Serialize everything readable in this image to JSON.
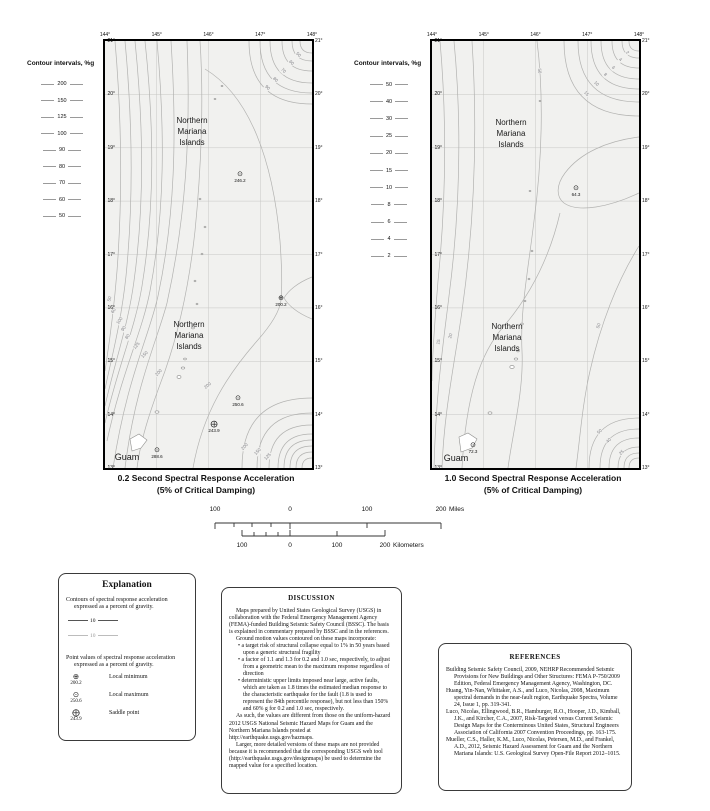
{
  "maps": [
    {
      "name": "0.2-second map",
      "legend_title": "Contour intervals, %g",
      "legend_values": [
        "200",
        "150",
        "125",
        "100",
        "90",
        "80",
        "70",
        "60",
        "50"
      ],
      "lon_labels": [
        "144°",
        "145°",
        "146°",
        "147°",
        "148°"
      ],
      "lat_labels": [
        "21°",
        "20°",
        "19°",
        "18°",
        "17°",
        "16°",
        "15°",
        "14°",
        "13°"
      ],
      "title_line1": "0.2 Second Spectral Response Acceleration",
      "title_line2": "(5% of Critical Damping)",
      "region_labels": [
        {
          "text": "Northern\nMariana\nIslands",
          "x": 87,
          "y": 91
        },
        {
          "text": "Northern\nMariana\nIslands",
          "x": 84,
          "y": 295
        },
        {
          "text": "Guam",
          "x": 22,
          "y": 416,
          "size": 9
        }
      ],
      "points": [
        {
          "value": "246.2",
          "type": "local-maximum",
          "symbol": "⊙",
          "x": 135,
          "y": 135
        },
        {
          "value": "200.2",
          "type": "local-minimum",
          "symbol": "⊕",
          "x": 176,
          "y": 259
        },
        {
          "value": "250.6",
          "type": "local-maximum",
          "symbol": "⊙",
          "x": 133,
          "y": 359
        },
        {
          "value": "243.9",
          "type": "saddle-point",
          "symbol": "⨁",
          "x": 109,
          "y": 385
        },
        {
          "value": "288.6",
          "type": "local-maximum",
          "symbol": "⊙",
          "x": 52,
          "y": 411
        }
      ],
      "contour_labels": [
        {
          "text": "50",
          "x": 5,
          "y": 258,
          "rot": -75
        },
        {
          "text": "60",
          "x": 9,
          "y": 270,
          "rot": -60
        },
        {
          "text": "100",
          "x": 15,
          "y": 280,
          "rot": -55
        },
        {
          "text": "90",
          "x": 19,
          "y": 288,
          "rot": -55
        },
        {
          "text": "80",
          "x": 23,
          "y": 296,
          "rot": -55
        },
        {
          "text": "125",
          "x": 32,
          "y": 305,
          "rot": -50
        },
        {
          "text": "150",
          "x": 40,
          "y": 314,
          "rot": -45
        },
        {
          "text": "200",
          "x": 54,
          "y": 332,
          "rot": -45
        },
        {
          "text": "200",
          "x": 103,
          "y": 345,
          "rot": -40
        },
        {
          "text": "200",
          "x": 140,
          "y": 406,
          "rot": -45
        },
        {
          "text": "150",
          "x": 153,
          "y": 411,
          "rot": -45
        },
        {
          "text": "125",
          "x": 163,
          "y": 416,
          "rot": -45
        },
        {
          "text": "90",
          "x": 162,
          "y": 47,
          "rot": 45
        },
        {
          "text": "80",
          "x": 170,
          "y": 39,
          "rot": 45
        },
        {
          "text": "70",
          "x": 178,
          "y": 30,
          "rot": 45
        },
        {
          "text": "60",
          "x": 186,
          "y": 22,
          "rot": 45
        },
        {
          "text": "50",
          "x": 193,
          "y": 14,
          "rot": 45
        }
      ]
    },
    {
      "name": "1.0-second map",
      "legend_title": "Contour intervals, %g",
      "legend_values": [
        "50",
        "40",
        "30",
        "25",
        "20",
        "15",
        "10",
        "8",
        "6",
        "4",
        "2"
      ],
      "lon_labels": [
        "144°",
        "145°",
        "146°",
        "147°",
        "148°"
      ],
      "lat_labels": [
        "21°",
        "20°",
        "19°",
        "18°",
        "17°",
        "16°",
        "15°",
        "14°",
        "13°"
      ],
      "title_line1": "1.0 Second Spectral Response Acceleration",
      "title_line2": "(5% of Critical Damping)",
      "region_labels": [
        {
          "text": "Northern\nMariana\nIslands",
          "x": 79,
          "y": 93
        },
        {
          "text": "Northern\nMariana\nIslands",
          "x": 75,
          "y": 297
        },
        {
          "text": "Guam",
          "x": 24,
          "y": 417,
          "size": 9
        }
      ],
      "points": [
        {
          "value": "64.3",
          "type": "local-maximum",
          "symbol": "⊙",
          "x": 144,
          "y": 149
        },
        {
          "value": "72.3",
          "type": "local-maximum",
          "symbol": "⊙",
          "x": 41,
          "y": 406
        }
      ],
      "contour_labels": [
        {
          "text": "2",
          "x": 195,
          "y": 12,
          "rot": 45
        },
        {
          "text": "4",
          "x": 188,
          "y": 19,
          "rot": 45
        },
        {
          "text": "6",
          "x": 181,
          "y": 27,
          "rot": 45
        },
        {
          "text": "8",
          "x": 173,
          "y": 34,
          "rot": 45
        },
        {
          "text": "10",
          "x": 164,
          "y": 43,
          "rot": 45
        },
        {
          "text": "15",
          "x": 154,
          "y": 53,
          "rot": 45
        },
        {
          "text": "50",
          "x": 107,
          "y": 30,
          "rot": 85
        },
        {
          "text": "50",
          "x": 167,
          "y": 285,
          "rot": -70
        },
        {
          "text": "50",
          "x": 168,
          "y": 391,
          "rot": -45
        },
        {
          "text": "40",
          "x": 177,
          "y": 400,
          "rot": -45
        },
        {
          "text": "25",
          "x": 190,
          "y": 412,
          "rot": -45
        },
        {
          "text": "20",
          "x": 19,
          "y": 295,
          "rot": -75
        },
        {
          "text": "15",
          "x": 7,
          "y": 301,
          "rot": -80
        }
      ]
    }
  ],
  "scalebars": {
    "miles": {
      "unit": "Miles",
      "ticks": [
        {
          "label": "100",
          "x": 25
        },
        {
          "label": "0",
          "x": 100
        },
        {
          "label": "100",
          "x": 177
        },
        {
          "label": "200",
          "x": 251
        }
      ]
    },
    "kilometers": {
      "unit": "Kilometers",
      "ticks": [
        {
          "label": "100",
          "x": 52
        },
        {
          "label": "0",
          "x": 100
        },
        {
          "label": "100",
          "x": 147
        },
        {
          "label": "200",
          "x": 195
        }
      ]
    }
  },
  "explanation": {
    "title": "Explanation",
    "contours_text": "Contours of spectral response acceleration expressed as a percent of gravity.",
    "samples": [
      {
        "label": "10",
        "style": "dark"
      },
      {
        "label": "10",
        "style": "light"
      }
    ],
    "points_text": "Point values of spectral response acceleration expressed as a percent of gravity.",
    "symbols": [
      {
        "symbol": "⊕",
        "value": "200.2",
        "label": "Local minimum"
      },
      {
        "symbol": "⊙",
        "value": "250.6",
        "label": "Local maximum"
      },
      {
        "symbol": "⨁",
        "value": "243.9",
        "label": "Saddle point"
      }
    ]
  },
  "discussion": {
    "title": "DISCUSSION",
    "para1": "Maps prepared by United States Geological Survey (USGS) in collaboration with the Federal Emergency Management Agency (FEMA)-funded Building Seismic Safety Council (BSSC).  The basis is explained in commentary prepared by BSSC and in the references.",
    "para2": "Ground motion values contoured on these maps incorporate:",
    "bullets": [
      "a target risk of structural collapse equal to 1% in 50 years based upon a generic structural fragility",
      "a factor of 1.1 and 1.3 for 0.2 and 1.0 sec, respectively, to adjust from a geometric mean to the maximum response regardless of direction",
      "deterministic upper limits imposed near large, active faults, which are taken as 1.8 times the estimated median response to the characteristic earthquake for the fault (1.8 is used to represent the 84th percentile response), but not less than 150% and 60% g for 0.2 and 1.0 sec, respectively."
    ],
    "para3": "As such, the values are different from those on the uniform-hazard 2012 USGS National Seismic Hazard Maps for Guam and the Northern Mariana Islands posted at http://earthquake.usgs.gov/hazmaps.",
    "para4": "Larger, more detailed versions of these maps are not provided because it is recommended that the corresponding USGS web tool (http://earthquake.usgs.gov/designmaps) be used to determine the mapped value for a specified location."
  },
  "references": {
    "title": "REFERENCES",
    "entries": [
      "Building Seismic Safety Council, 2009, NEHRP Recommended Seismic Provisions for New Buildings and Other Structures: FEMA P-750/2009 Edition, Federal Emergency Management Agency, Washington, DC.",
      "Huang, Yin-Nan, Whittaker, A.S., and Luco, Nicolas, 2008, Maximum spectral demands in the near-fault region, Earthquake Spectra, Volume 24, Issue 1, pp. 319-341.",
      "Luco, Nicolas, Ellingwood, B.R., Hamburger, R.O., Hooper, J.D., Kimball, J.K., and Kircher, C.A., 2007, Risk-Targeted versus Current Seismic Design Maps for the Conterminous United States, Structural Engineers Association of California 2007 Convention Proceedings, pp. 163-175.",
      "Mueller, C.S., Haller, K.M., Luco, Nicolas, Petersen, M.D., and Frankel, A.D., 2012, Seismic Hazard Assessment for Guam and the Northern Mariana Islands: U.S. Geological Survey Open-File Report 2012–1015."
    ]
  }
}
